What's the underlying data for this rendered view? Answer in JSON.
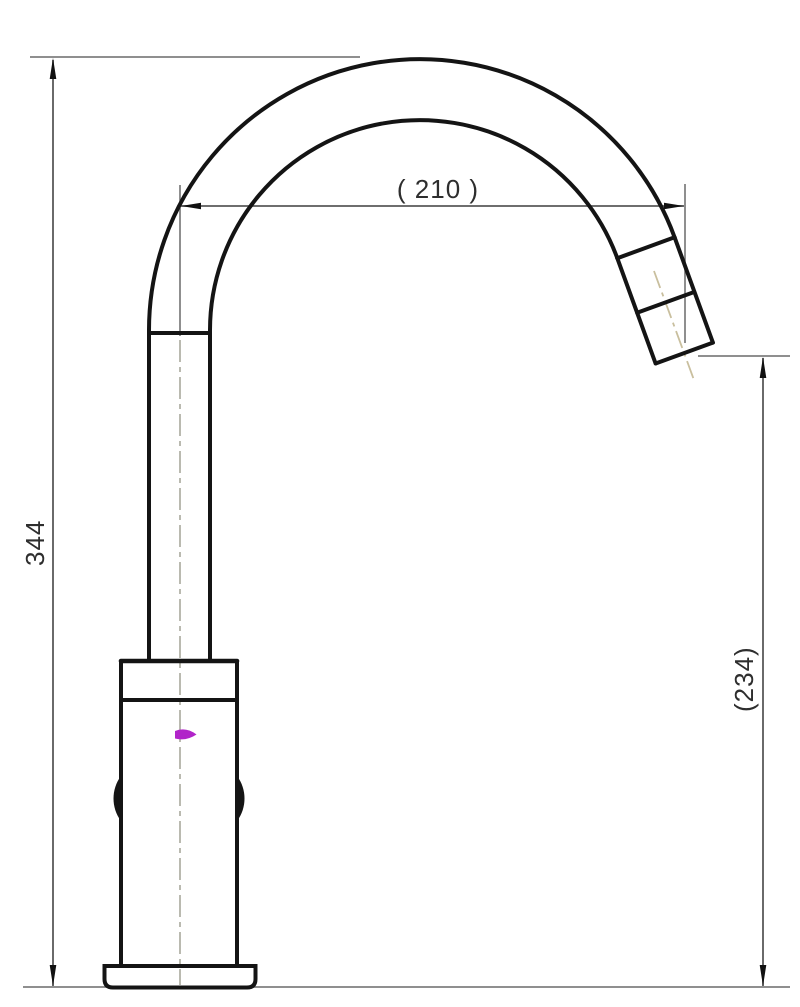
{
  "drawing": {
    "title": "faucet-technical-drawing",
    "view": "side elevation of gooseneck faucet with dimension lines",
    "dimensions": {
      "overall_height": "344",
      "spout_reach": "( 210 )",
      "spout_outlet_height": "(234)"
    },
    "colors": {
      "background": "#ffffff",
      "outline": "#141414",
      "dimension_lines": "#5a5a5a",
      "dimension_text": "#2e2e2e",
      "centerline": "#a9a99c",
      "spout_centerline": "#c9bf9e",
      "accent_mark": "#b124c9"
    }
  }
}
